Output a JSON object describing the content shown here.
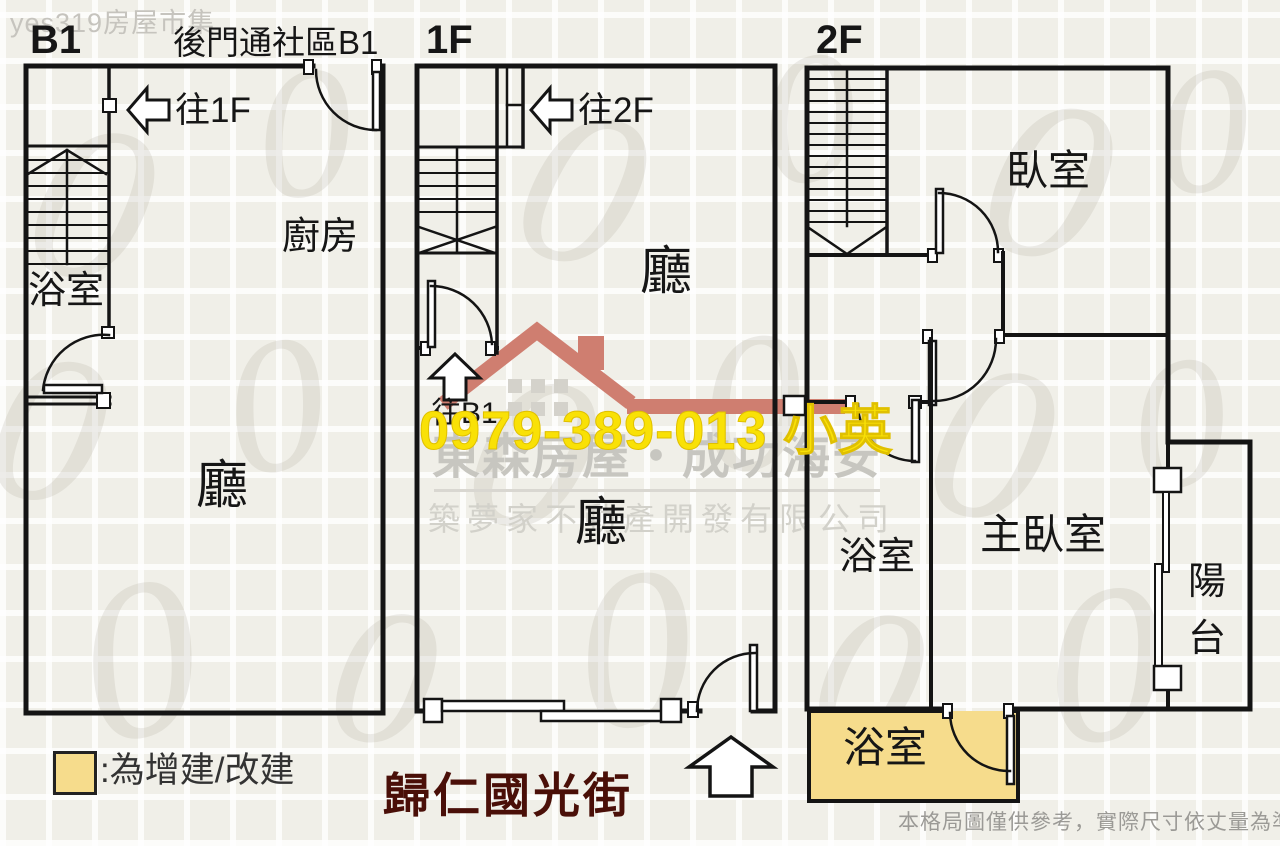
{
  "site_watermark": "yes319房屋市集",
  "phone_watermark": "0979-389-013 小英",
  "brand": {
    "line1": "東森房屋・成功海安",
    "line2": "築夢家不動產開發有限公司"
  },
  "street_label": "歸仁國光街",
  "disclaimer": "本格局圖僅供參考，實際尺寸依丈量為準",
  "legend": {
    "label": ":為增建/改建",
    "swatch_color": "#f6dc8c"
  },
  "background_glyph": "0",
  "floors": {
    "b1": {
      "label": "B1",
      "back_door_note": "後門通社區B1",
      "stair_note": "往1F",
      "rooms": {
        "bath": "浴室",
        "kitchen": "廚房",
        "hall": "廳"
      }
    },
    "f1": {
      "label": "1F",
      "stair_up_note": "往2F",
      "stair_down_note": "往B1",
      "rooms": {
        "hall_front": "廳",
        "hall_back": "廳"
      }
    },
    "f2": {
      "label": "2F",
      "rooms": {
        "bedroom": "臥室",
        "bath": "浴室",
        "master_bedroom": "主臥室",
        "balcony": "陽台",
        "bath_addition": "浴室"
      }
    }
  },
  "colors": {
    "addition_fill": "#f6dc8c",
    "phone_yellow": "#f9e106",
    "logo_red": "#cf7e70",
    "street_text": "#4a0f08"
  }
}
